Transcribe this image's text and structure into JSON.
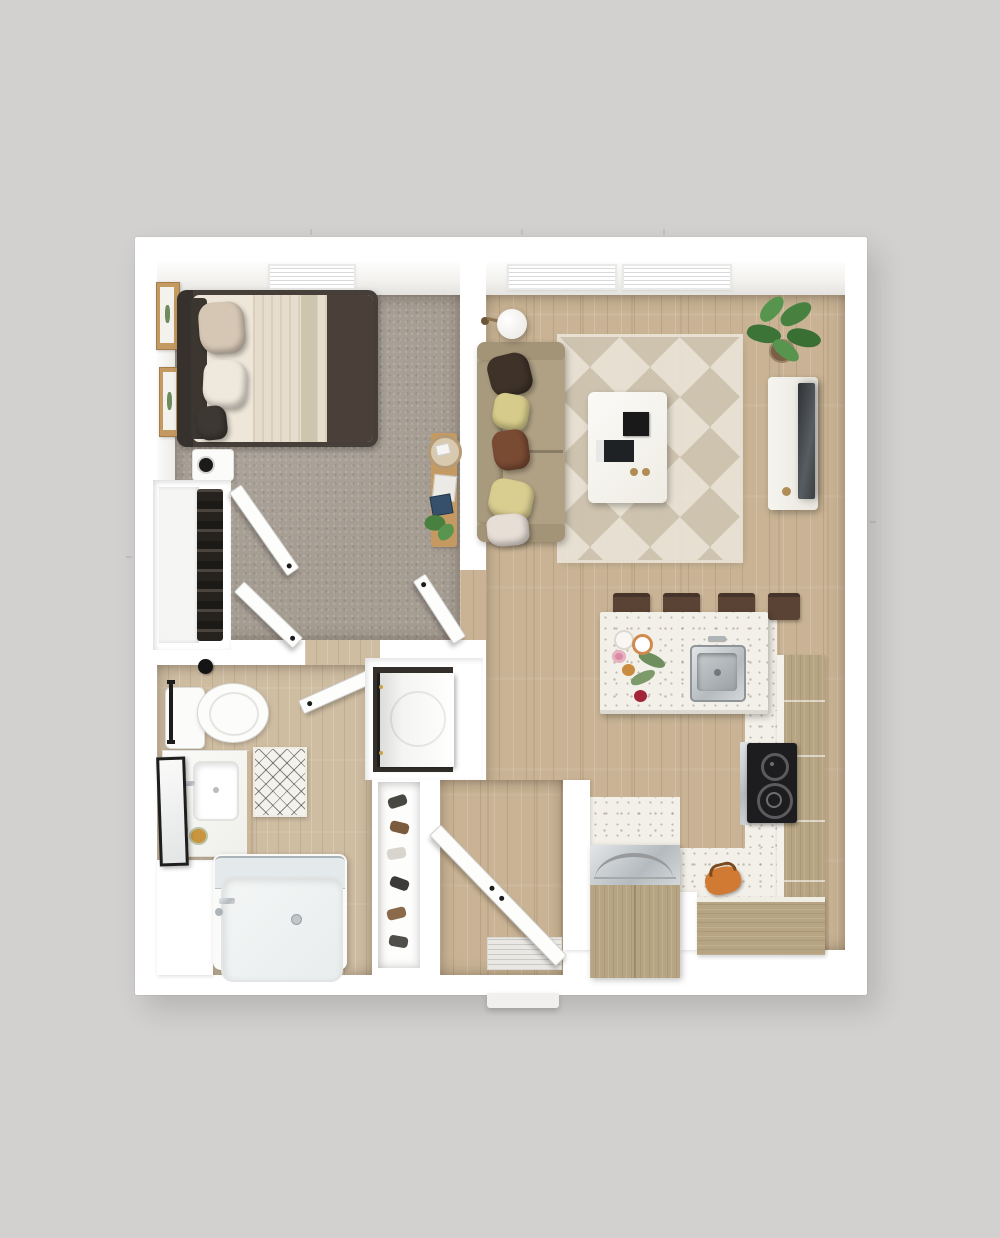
{
  "scene": {
    "title": "one-bedroom-apartment-3d-floor-plan",
    "view": "top-down-3d-render",
    "background_color": "#d2d1cf",
    "wall_color": "#ffffff"
  },
  "palette": {
    "bg": "#d2d1cf",
    "wall": "#ffffff",
    "carpet": "#a59c92",
    "wood": "#c9b394",
    "bath_wood": "#cfbda2",
    "cabinet_wood": "#b7a483",
    "terrazzo": "#f3f0e9",
    "rug_light": "#eae4d8",
    "rug_dark": "#cfc5b2",
    "sofa": "#b0a184",
    "bed_frame": "#453e39",
    "blanket_dark": "#4b4039",
    "linen": "#eee6d9",
    "steel": "#b9bfc3",
    "appliance_black": "#1d1d1f",
    "plant_green": "#47803f",
    "kettle_orange": "#d07a33"
  },
  "rooms": [
    {
      "name": "bedroom",
      "floor": "gray carpet",
      "windows": 1
    },
    {
      "name": "living-room",
      "floor": "light oak plank",
      "windows": 2
    },
    {
      "name": "kitchen-dining",
      "floor": "oak plank with white terrazzo work zone",
      "windows": 0
    },
    {
      "name": "bathroom",
      "floor": "light wood-look tile",
      "windows": 0
    },
    {
      "name": "hall-entry",
      "floor": "oak plank",
      "windows": 0
    },
    {
      "name": "bedroom-closet",
      "floor": "white",
      "windows": 0
    },
    {
      "name": "laundry-nook",
      "floor": "dark",
      "windows": 0
    },
    {
      "name": "shoe-closet",
      "floor": "white",
      "windows": 0
    }
  ],
  "furniture": {
    "bedroom": [
      "upholstered bed with dark frame and layered cream/brown bedding",
      "two beige throw pillows",
      "two framed botanical prints on wall",
      "white nightstand with black lamp",
      "reach-in closet with hanging clothes and two bifold doors",
      "narrow wood ledge with woven tray, books and trailing plant"
    ],
    "living_room": [
      "tan fabric sofa with five throw pillows",
      "white arc floor lamp",
      "geometric triangle-pattern area rug",
      "white coffee table with two black books and brass knobs",
      "white media console with wall-mounted TV",
      "potted fiddle-leaf fig plant"
    ],
    "kitchen": [
      "white speckled island with stainless undermount sink and faucet",
      "four dark-brown bar stools",
      "flower and plate arrangement on island",
      "black two-burner cooktop in L-shaped counter",
      "wood-front L-shaped cabinet run",
      "wood-front refrigerator with curved steel handles",
      "orange kettle on floor by counter"
    ],
    "bathroom": [
      "toilet with tank and black wall button",
      "white vanity with rectangular sink, faucet and flowers",
      "black-framed leaning mirror",
      "black towel bar",
      "diamond-lattice bath mat",
      "bathtub with glass screen, chrome filler and drain",
      "front-load washer in laundry nook"
    ],
    "hall_entry": [
      "open entry door",
      "ribbed doormat",
      "shoe closet with six pairs of shoes",
      "open bedroom door",
      "open bathroom door",
      "white exterior stoop"
    ]
  },
  "counts": {
    "windows": 3,
    "open_doors": 6,
    "bar_stools": 4,
    "sofa_pillows": 5,
    "shoe_pairs": 6,
    "wall_frames": 2,
    "cooktop_burners": 2
  }
}
